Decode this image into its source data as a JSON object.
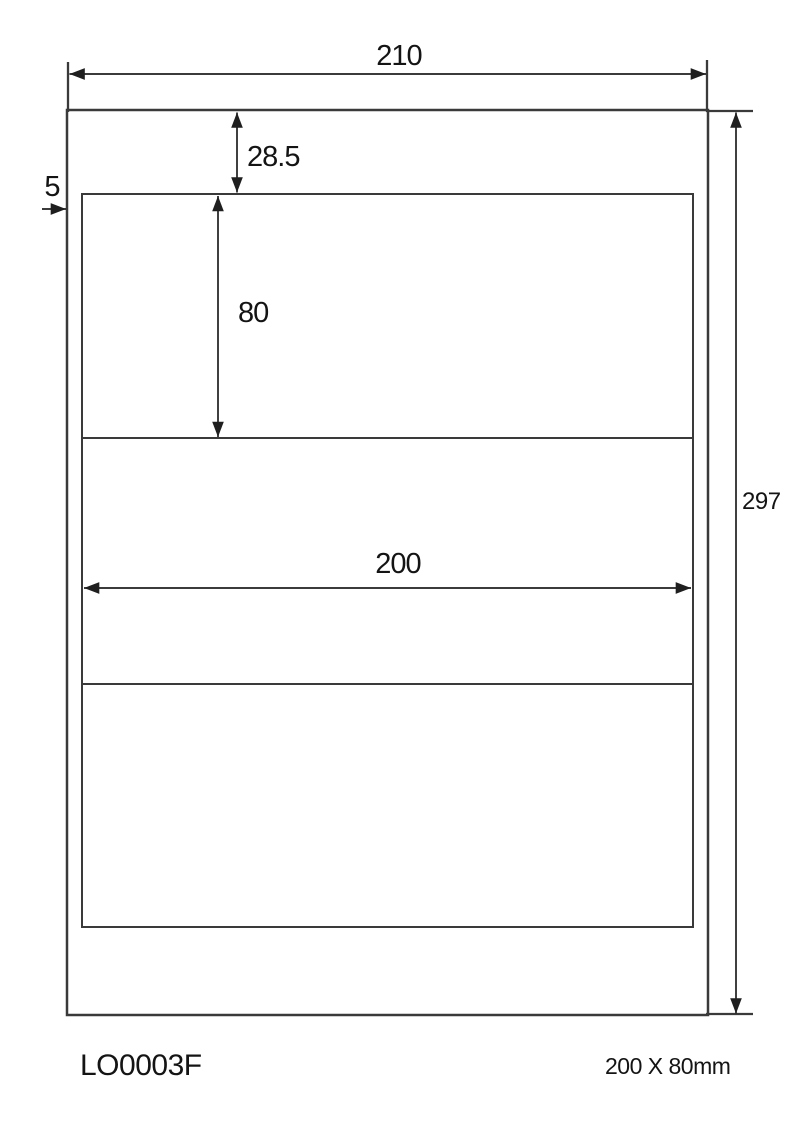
{
  "diagram": {
    "type": "label-sheet-dimension-drawing",
    "label_rows": 3,
    "dimensions": {
      "page_width": "210",
      "page_height": "297",
      "top_margin": "28.5",
      "left_margin": "5",
      "label_width": "200",
      "label_height": "80"
    },
    "footer": {
      "product_code": "LO0003F",
      "label_size": "200 X 80mm"
    },
    "colors": {
      "background": "#ffffff",
      "outline": "#3a3a3a",
      "dimension_line": "#1f1f1f",
      "text": "#141414"
    }
  }
}
